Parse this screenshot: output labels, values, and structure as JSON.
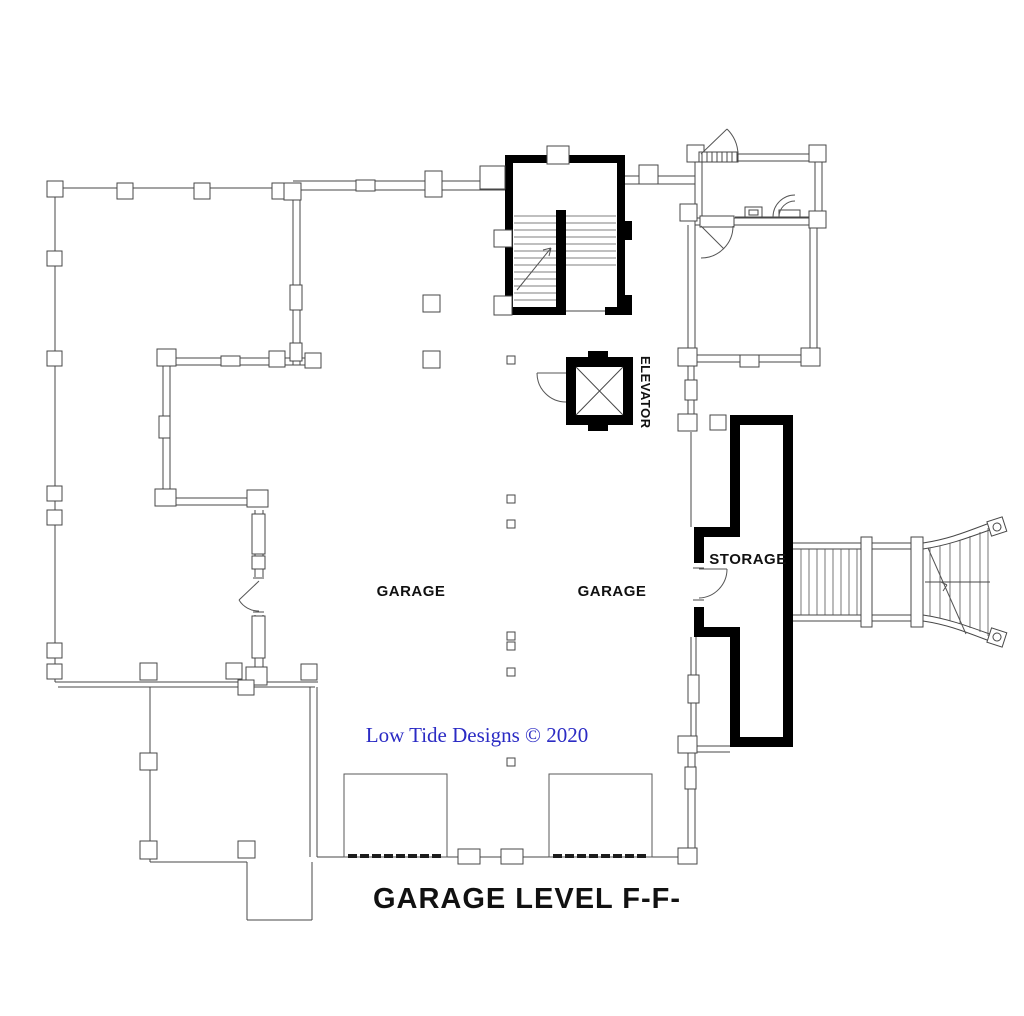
{
  "plan": {
    "title": "GARAGE LEVEL F-F-",
    "credit": "Low Tide Designs © 2020",
    "rooms": {
      "garage_left": "GARAGE",
      "garage_right": "GARAGE",
      "storage": "STORAGE",
      "elevator": "ELEVATOR"
    },
    "colors": {
      "line": "#474747",
      "wall": "#000000",
      "credit_text": "#2b2bc4",
      "label_text": "#111111",
      "background": "#ffffff"
    }
  }
}
